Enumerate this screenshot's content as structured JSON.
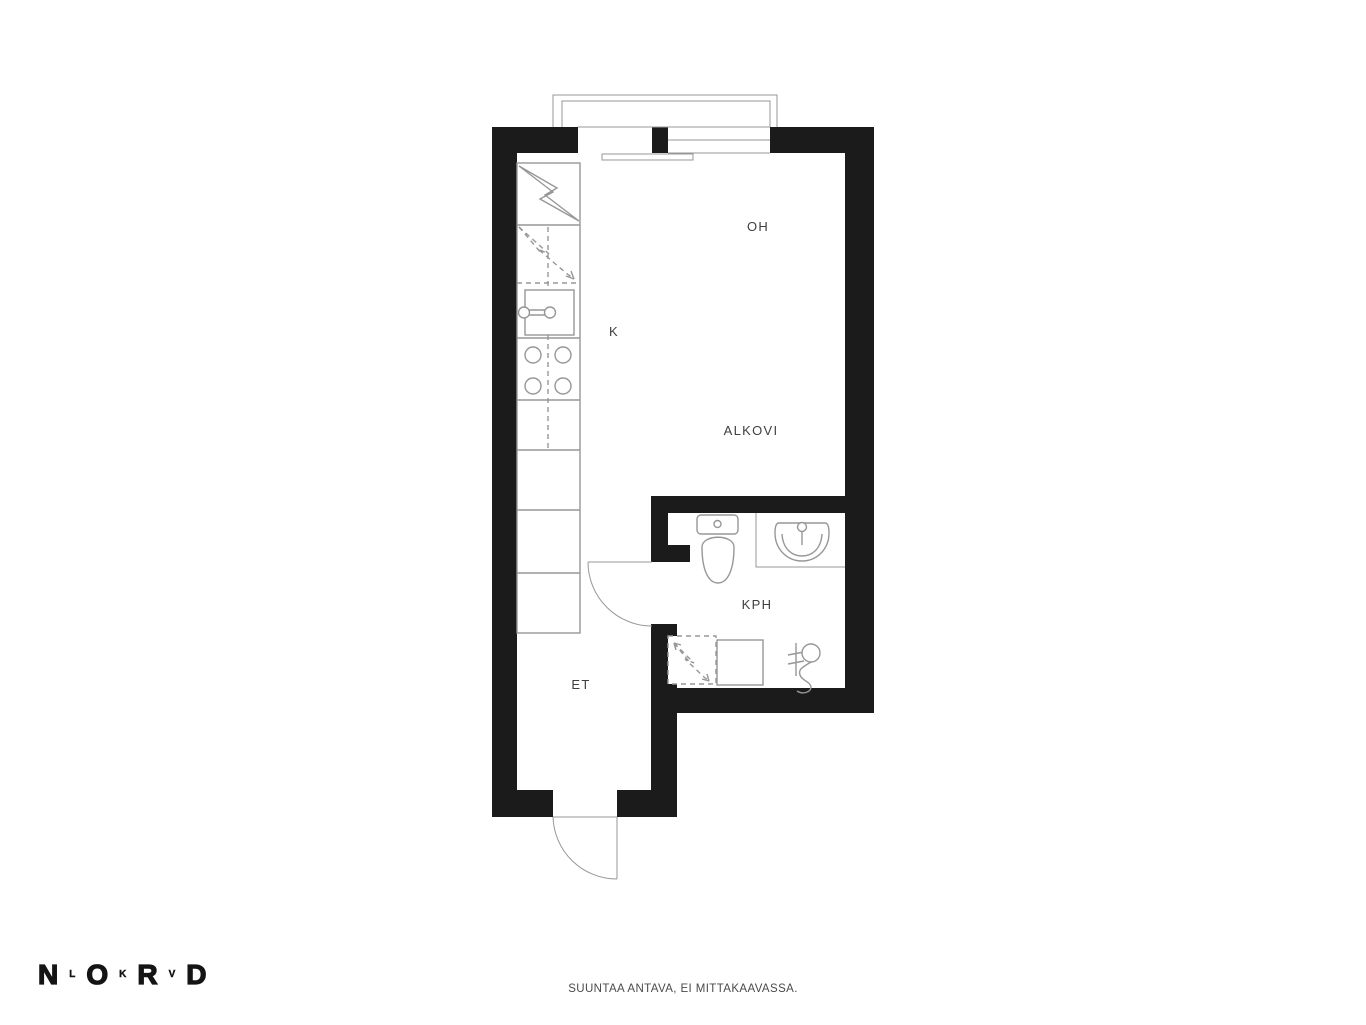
{
  "floorplan": {
    "rooms": {
      "oh": "OH",
      "k": "K",
      "alkovi": "ALKOVI",
      "kph": "KPH",
      "et": "ET"
    }
  },
  "branding": {
    "logo": {
      "n": "N",
      "l": "L",
      "o": "O",
      "k": "K",
      "r": "R",
      "v": "V",
      "d": "D"
    }
  },
  "footer": {
    "disclaimer": "SUUNTAA ANTAVA, EI MITTAKAAVASSA."
  },
  "colors": {
    "wall": "#1b1b1b",
    "line": "#979797",
    "label_text": "#3f3f3f"
  }
}
